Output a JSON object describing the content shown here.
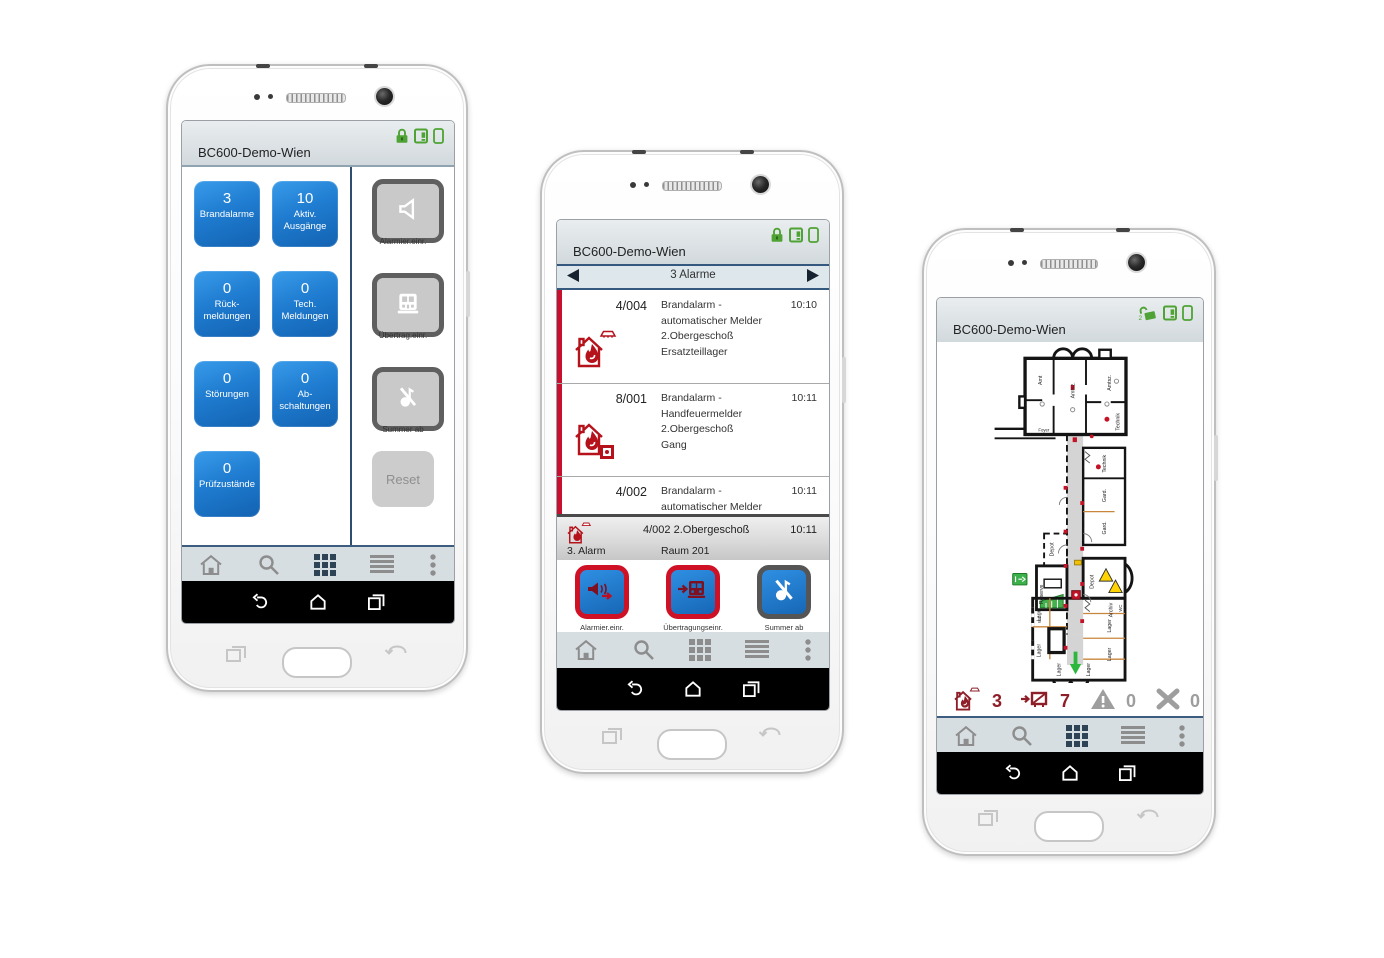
{
  "app": {
    "title": "BC600-Demo-Wien"
  },
  "colors": {
    "tile_blue": "#1f7cd0",
    "alarm_red": "#c8102e",
    "dark_red": "#8e1f28",
    "status_green": "#4ea334",
    "nav_active": "#2e4356",
    "nav_gray": "#8d8d8d"
  },
  "nav": {
    "items": [
      {
        "icon": "home-icon"
      },
      {
        "icon": "search-icon"
      },
      {
        "icon": "grid-view-icon"
      },
      {
        "icon": "list-view-icon"
      },
      {
        "icon": "overflow-menu-icon"
      }
    ],
    "android": [
      "back-icon",
      "home-icon",
      "recents-icon"
    ]
  },
  "phone1": {
    "header": {
      "title": "BC600-Demo-Wien",
      "status_icons": [
        "lock-closed-icon",
        "panel-icon",
        "phone-icon"
      ]
    },
    "tiles": [
      {
        "value": "3",
        "line1": "Brandalarme",
        "line2": ""
      },
      {
        "value": "10",
        "line1": "Aktiv.",
        "line2": "Ausgänge"
      },
      {
        "value": "0",
        "line1": "Rück-",
        "line2": "meldungen"
      },
      {
        "value": "0",
        "line1": "Tech.",
        "line2": "Meldungen"
      },
      {
        "value": "0",
        "line1": "Störungen",
        "line2": ""
      },
      {
        "value": "0",
        "line1": "Ab-",
        "line2": "schaltungen"
      },
      {
        "value": "0",
        "line1": "Prüfzustände",
        "line2": ""
      }
    ],
    "side_buttons": [
      {
        "icon": "alarm-device-icon",
        "label": "Alarmier.einr."
      },
      {
        "icon": "transmission-device-icon",
        "label": "Übertrag.einr."
      },
      {
        "icon": "buzzer-off-icon",
        "label": "Summer ab"
      }
    ],
    "reset_label": "Reset"
  },
  "phone2": {
    "header": {
      "title": "BC600-Demo-Wien",
      "status_icons": [
        "lock-closed-icon",
        "panel-icon",
        "phone-icon"
      ]
    },
    "pager": {
      "label": "3 Alarme"
    },
    "alarms": [
      {
        "id": "4/004",
        "line1": "Brandalarm -",
        "line2": "automatischer Melder",
        "line3": "2.Obergeschoß",
        "line4": "Ersatzteillager",
        "time": "10:10",
        "icon": "fire-house-detector-icon"
      },
      {
        "id": "8/001",
        "line1": "Brandalarm -",
        "line2": "Handfeuermelder",
        "line3": "2.Obergeschoß",
        "line4": "Gang",
        "time": "10:11",
        "icon": "fire-house-callpoint-icon"
      },
      {
        "id": "4/002",
        "line1": "Brandalarm -",
        "line2": "automatischer Melder",
        "line3": "",
        "line4": "",
        "time": "10:11",
        "icon": ""
      }
    ],
    "detail": {
      "info": "4/002  2.Obergeschoß",
      "time": "10:11",
      "alarm_no": "3. Alarm",
      "room": "Raum 201"
    },
    "action_buttons": [
      {
        "icon": "alarm-device-active-icon",
        "line1": "Alarmier.einr.",
        "line2": "aktiv."
      },
      {
        "icon": "transmission-device-active-icon",
        "line1": "Übertragungseinr.",
        "line2": "aktiv."
      },
      {
        "icon": "buzzer-off-icon",
        "line1": "Summer ab",
        "line2": ""
      }
    ]
  },
  "phone3": {
    "header": {
      "title": "BC600-Demo-Wien",
      "status_icons": [
        "lock-open-icon",
        "panel-icon",
        "phone-icon"
      ],
      "lock_badge": "2"
    },
    "status_bar": [
      {
        "icon": "fire-alarm-icon",
        "value": "3",
        "state": "red"
      },
      {
        "icon": "transmission-active-icon",
        "value": "7",
        "state": "red"
      },
      {
        "icon": "warning-icon",
        "value": "0",
        "state": "gray"
      },
      {
        "icon": "cross-icon",
        "value": "0",
        "state": "gray"
      }
    ],
    "map": {
      "labels": {
        "amt": "Amt",
        "amtsz1": "Amtsz.",
        "amtsz2": "Amtsz.",
        "foyer": "Foyer",
        "technik1": "Technik",
        "technik2": "Technik",
        "gard1": "Gard.",
        "gard2": "Gard.",
        "depot1": "Depot",
        "depot2": "Depot",
        "reserve": "Reserve",
        "wc1": "WC",
        "wc2": "WC",
        "archiv": "Archiv",
        "lager1": "Lager",
        "lager2": "Lager",
        "lager3": "Lager",
        "lager4": "Lager",
        "lager5": "Lager",
        "lager6": "Lager"
      }
    }
  }
}
